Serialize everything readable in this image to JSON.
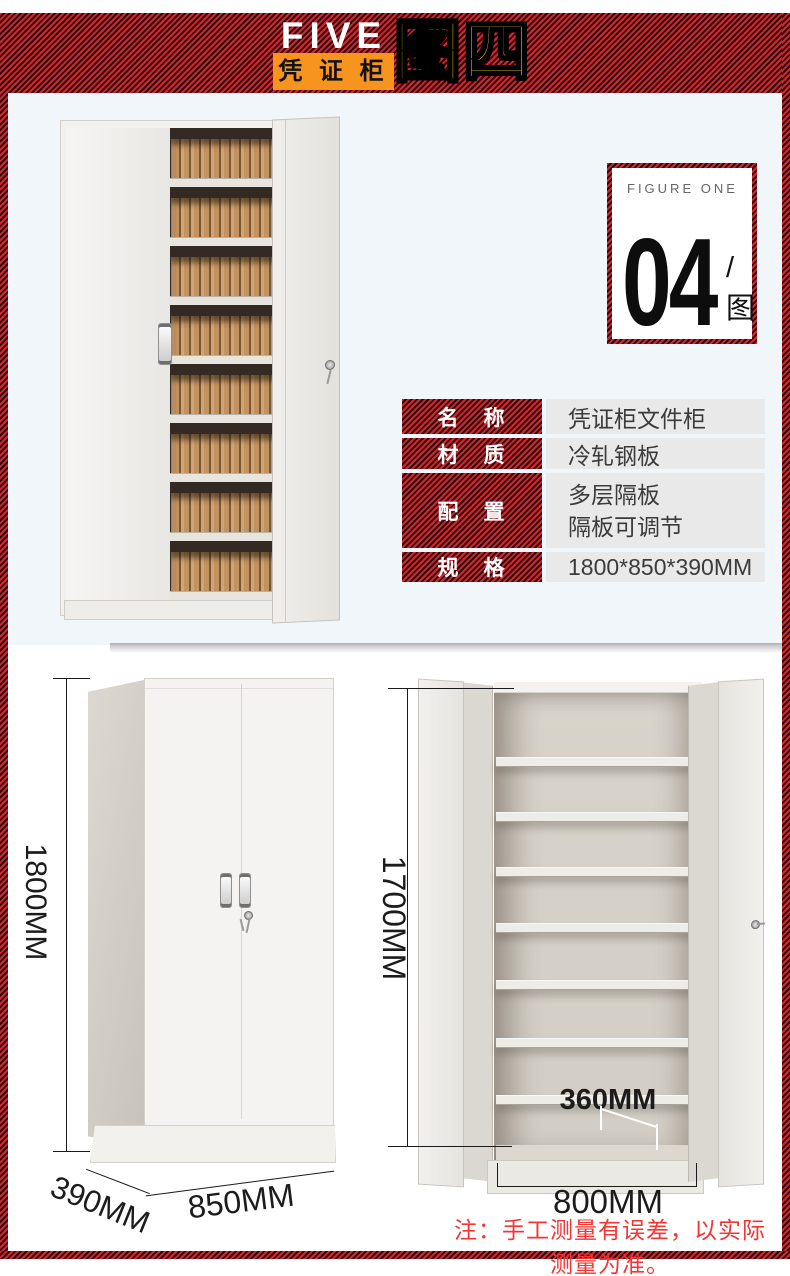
{
  "header": {
    "brand": "FIVE",
    "brand_sub": "凭 证 柜",
    "figure_title": "图四"
  },
  "figure_badge": {
    "label": "FIGURE ONE",
    "number": "04",
    "suffix": "/图"
  },
  "spec_table": {
    "rows": [
      {
        "label": "名　称",
        "value": "凭证柜文件柜"
      },
      {
        "label": "材　质",
        "value": "冷轧钢板"
      },
      {
        "label": "配　置",
        "value": "多层隔板",
        "value2": "隔板可调节"
      },
      {
        "label": "规　格",
        "value": "1800*850*390MM"
      }
    ]
  },
  "dimensions": {
    "closed_cabinet": {
      "height": "1800MM",
      "depth": "390MM",
      "width": "850MM"
    },
    "open_cabinet": {
      "height": "1700MM",
      "shelf_depth": "360MM",
      "inner_width": "800MM"
    }
  },
  "note": "注：手工测量有误差，以实际测量为准。",
  "colors": {
    "hatch_red": "#cf2830",
    "hatch_dark": "#32070a",
    "orange": "#f7941e",
    "yellow": "#ffe300",
    "note_red": "#f63434",
    "photo_bg": "#f1f6fa",
    "table_value_bg": "#e9e9e9"
  }
}
